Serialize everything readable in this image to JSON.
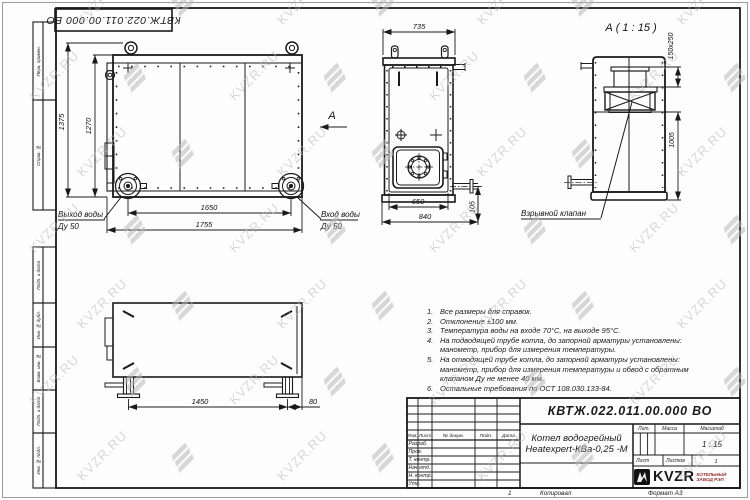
{
  "page": {
    "watermark_text": "KVZR.RU",
    "stamp_top": "КВТЖ.022.011.00.000 ВО",
    "footer": {
      "copy_num": "1",
      "copied_label": "Копировал",
      "format_label": "Формат А3"
    }
  },
  "frame": {
    "side_labels": [
      "Перв. примен.",
      "Справ. №",
      "Подп. и дата",
      "Инв. № дубл.",
      "Взам. инв. №",
      "Подп. и дата",
      "Инв. № подл."
    ]
  },
  "views": {
    "side": {
      "dim_height_outer": "1375",
      "dim_height_inner": "1270",
      "dim_width_inner": "1650",
      "dim_width_outer": "1755",
      "outlet_label_1": "Выход воды",
      "outlet_label_2": "Ду 50",
      "inlet_label_1": "Вход воды",
      "inlet_label_2": "Ду 50",
      "section_arrow_label": "А"
    },
    "front": {
      "dim_top": "735",
      "dim_bottom_inner": "650",
      "dim_bottom_outer": "840",
      "dim_pipe_offset": "105"
    },
    "detail": {
      "title": "А ( 1 : 15 )",
      "dim_valve": "150х250",
      "dim_height": "1005",
      "callout": "Взрывной клапан"
    },
    "bottom": {
      "dim_legs": "1450",
      "dim_offset": "80"
    }
  },
  "notes": [
    {
      "num": "1.",
      "lines": [
        "Все размеры для справок."
      ]
    },
    {
      "num": "2.",
      "lines": [
        "Отклонение ±100 мм."
      ]
    },
    {
      "num": "3.",
      "lines": [
        "Температура воды на входе 70°С, на выходе 95°С."
      ]
    },
    {
      "num": "4.",
      "lines": [
        "На подводящей трубе котла, до запорной арматуры установлены:",
        "манометр, прибор для измерения температуры."
      ]
    },
    {
      "num": "5.",
      "lines": [
        "На отводящей трубе котла, до запорной арматуры установлены:",
        "манометр, прибор для измерения температуры и обвод с обратным",
        "клапаном Ду не менее 40 мм."
      ]
    },
    {
      "num": "6.",
      "lines": [
        "Остальные требования по ОСТ 108.030.133-84."
      ]
    }
  ],
  "title_block": {
    "doc_number": "КВТЖ.022.011.00.000 ВО",
    "name_line1": "Котел водогрейный",
    "name_line2": "Heatexpert-КВа-0,25 -М",
    "header_cols": [
      "Изм.",
      "Лист",
      "№ докум.",
      "Подп.",
      "Дата"
    ],
    "sign_rows": [
      "Разраб.",
      "Пров.",
      "Т. контр.",
      "Нач.отд.",
      "Н. контр.",
      "Утв."
    ],
    "lit_label": "Лит.",
    "mass_label": "Масса",
    "scale_label": "Масштаб",
    "scale_value": "1 : 15",
    "sheet_label": "Лист",
    "sheets_label": "Листов",
    "sheets_value": "1",
    "logo_text": "KVZR",
    "logo_sub1": "КОТЕЛЬНЫЙ",
    "logo_sub2": "ЗАВОД РЭП",
    "accent_color": "#9e2b25"
  }
}
